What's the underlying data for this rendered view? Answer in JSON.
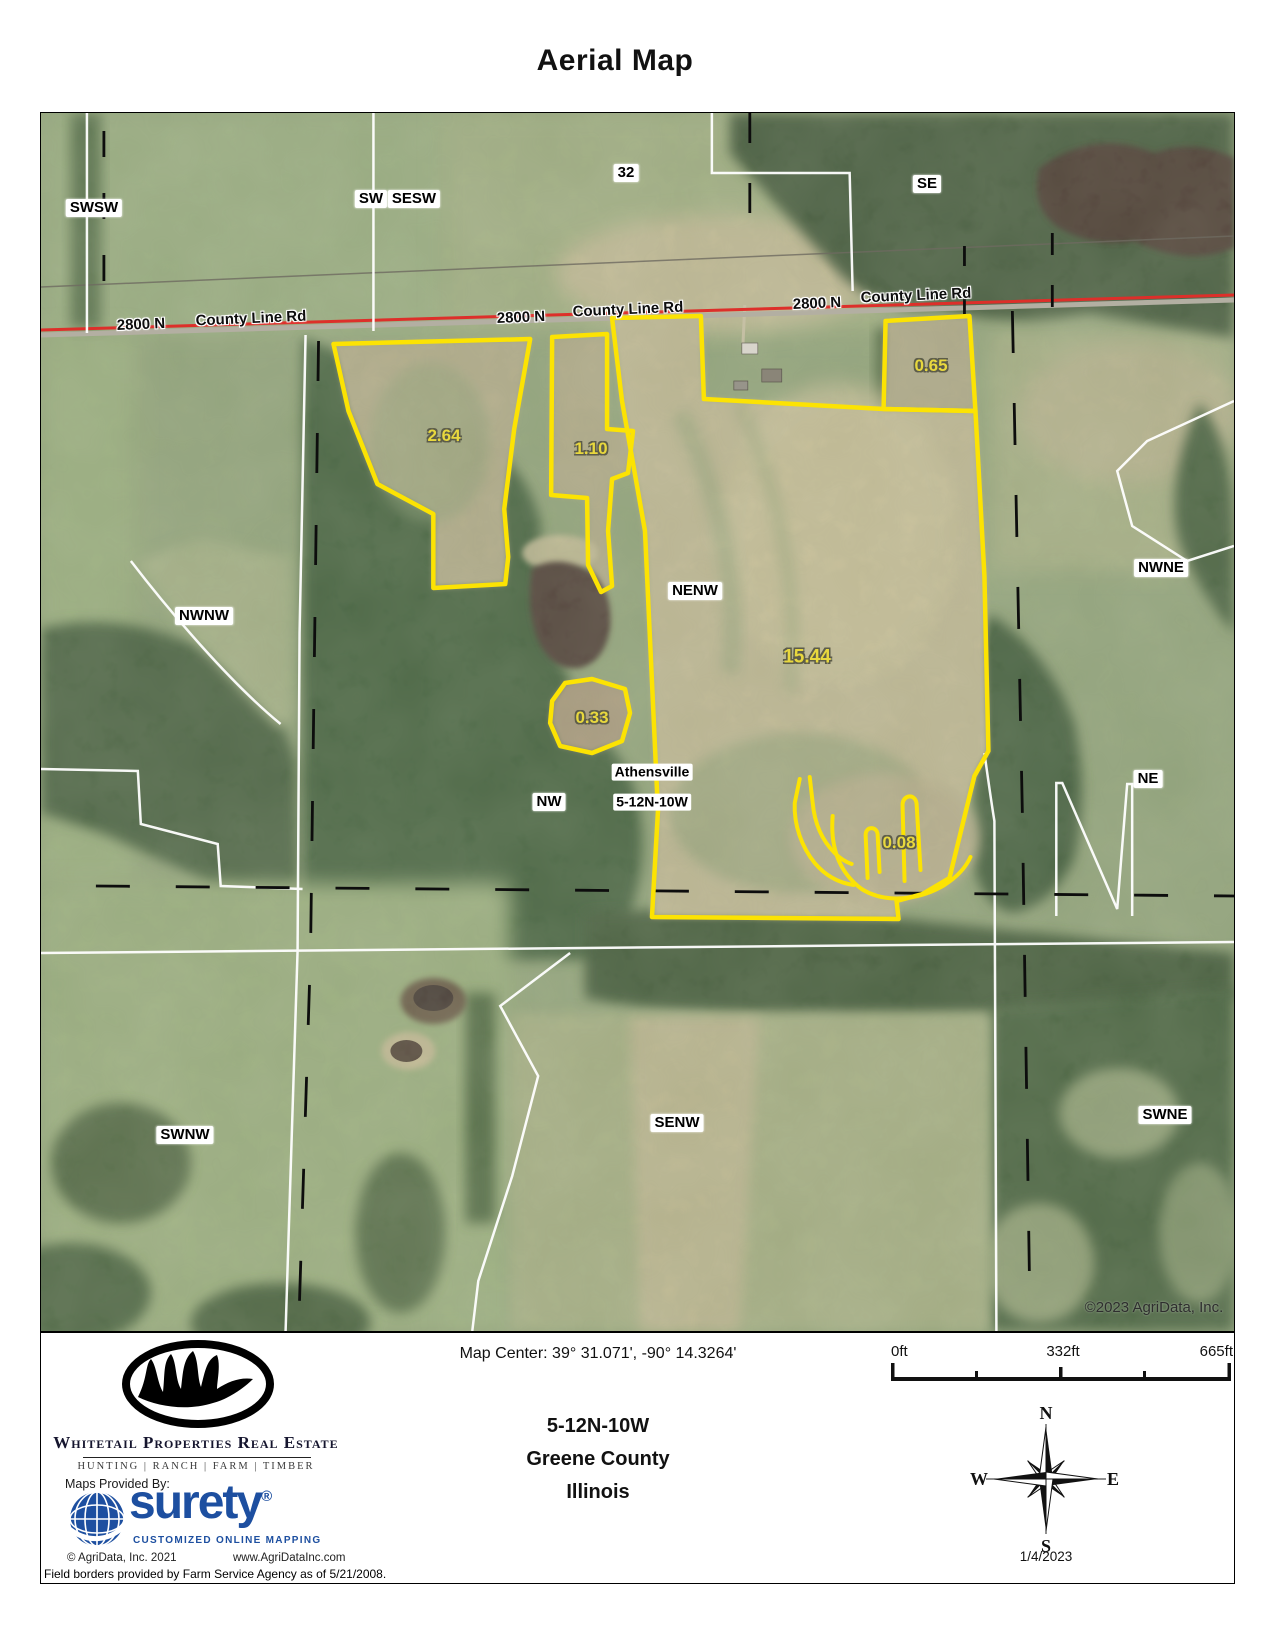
{
  "title": "Aerial Map",
  "map": {
    "copyright": "©2023 AgriData, Inc.",
    "colors": {
      "parcel_outline": "#fce303",
      "road_highlight": "#dd2f2a",
      "section_line_white": "#ffffff",
      "section_line_dashed": "#111111",
      "surety_blue": "#1d4fa0"
    },
    "labels": [
      {
        "text": "SWSW",
        "type": "section",
        "x": 53,
        "y": 95
      },
      {
        "text": "SW",
        "type": "section",
        "x": 330,
        "y": 86
      },
      {
        "text": "SESW",
        "type": "section",
        "x": 373,
        "y": 86
      },
      {
        "text": "32",
        "type": "section",
        "x": 585,
        "y": 60
      },
      {
        "text": "SE",
        "type": "section",
        "x": 886,
        "y": 71
      },
      {
        "text": "NWNW",
        "type": "section",
        "x": 163,
        "y": 503
      },
      {
        "text": "NENW",
        "type": "section",
        "x": 654,
        "y": 478
      },
      {
        "text": "NWNE",
        "type": "section",
        "x": 1120,
        "y": 455
      },
      {
        "text": "NW",
        "type": "section",
        "x": 508,
        "y": 689
      },
      {
        "text": "NE",
        "type": "section",
        "x": 1107,
        "y": 666
      },
      {
        "text": "SWNW",
        "type": "section",
        "x": 144,
        "y": 1022
      },
      {
        "text": "SENW",
        "type": "section",
        "x": 636,
        "y": 1010
      },
      {
        "text": "SWNE",
        "type": "section",
        "x": 1124,
        "y": 1002
      },
      {
        "text": "Athensville",
        "type": "place",
        "x": 611,
        "y": 659
      },
      {
        "text": "5-12N-10W",
        "type": "place",
        "x": 611,
        "y": 689
      },
      {
        "text": "2800 N",
        "type": "road",
        "x": 100,
        "y": 212,
        "rot": -2.5
      },
      {
        "text": "County Line Rd",
        "type": "road",
        "x": 210,
        "y": 206,
        "rot": -2.5
      },
      {
        "text": "2800 N",
        "type": "road",
        "x": 480,
        "y": 205,
        "rot": -2.5
      },
      {
        "text": "County Line Rd",
        "type": "road",
        "x": 587,
        "y": 197,
        "rot": -2.5
      },
      {
        "text": "2800 N",
        "type": "road",
        "x": 776,
        "y": 191,
        "rot": -2.5
      },
      {
        "text": "County Line Rd",
        "type": "road",
        "x": 875,
        "y": 183,
        "rot": -2.5
      },
      {
        "text": "2.64",
        "type": "area",
        "x": 403,
        "y": 323
      },
      {
        "text": "1.10",
        "type": "area",
        "x": 550,
        "y": 336
      },
      {
        "text": "0.65",
        "type": "area",
        "x": 890,
        "y": 253
      },
      {
        "text": "15.44",
        "type": "area area-big",
        "x": 766,
        "y": 545
      },
      {
        "text": "0.33",
        "type": "area",
        "x": 551,
        "y": 605
      },
      {
        "text": "0.08",
        "type": "area",
        "x": 858,
        "y": 730
      },
      {
        "text": "©2023 AgriData, Inc.",
        "type": "copyright",
        "x": 1113,
        "y": 1195
      }
    ]
  },
  "footer": {
    "brand": {
      "name": "Whitetail Properties Real Estate",
      "tagline": "HUNTING | RANCH | FARM | TIMBER",
      "maps_provided_by": "Maps Provided By:",
      "surety_name": "surety",
      "surety_reg": "®",
      "surety_tagline": "CUSTOMIZED ONLINE MAPPING",
      "agridata_copyright": "© AgriData, Inc. 2021",
      "agridata_url": "www.AgriDataInc.com"
    },
    "map_center": "Map Center: 39° 31.071',  -90° 14.3264'",
    "location": {
      "trs": "5-12N-10W",
      "county": "Greene County",
      "state": "Illinois"
    },
    "scale": {
      "start": "0ft",
      "middle": "332ft",
      "end": "665ft"
    },
    "compass": {
      "n": "N",
      "s": "S",
      "e": "E",
      "w": "W"
    },
    "date": "1/4/2023",
    "field_borders_note": "Field borders provided by Farm Service Agency as of 5/21/2008."
  }
}
